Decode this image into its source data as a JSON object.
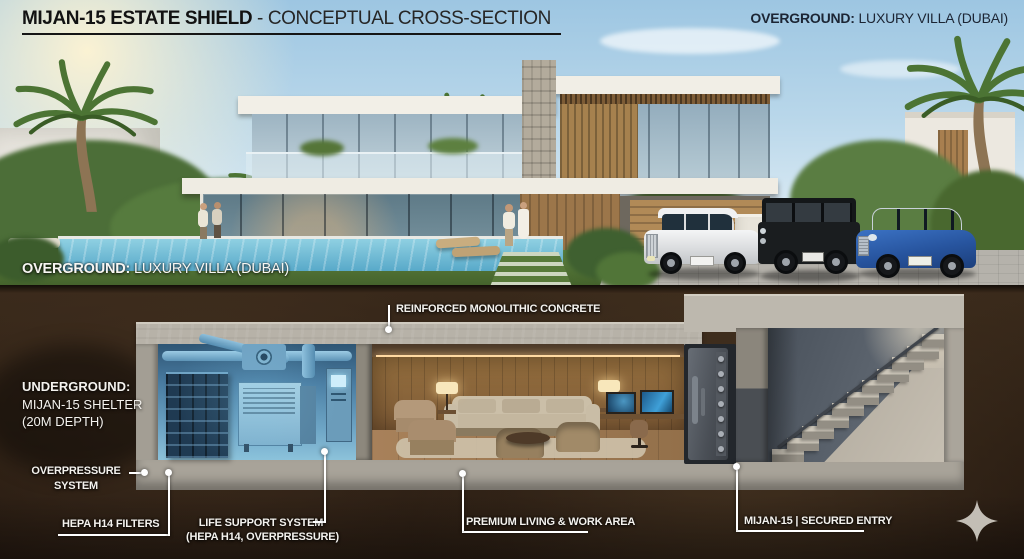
{
  "header": {
    "title_bold": "MIJAN-15 ESTATE SHIELD",
    "title_rest": " - CONCEPTUAL CROSS-SECTION",
    "corner_bold": "OVERGROUND:",
    "corner_rest": " LUXURY VILLA (DUBAI)"
  },
  "overground": {
    "bold": "OVERGROUND:",
    "rest": " LUXURY VILLA (DUBAI)"
  },
  "underground": {
    "line1": "UNDERGROUND:",
    "line2": "MIJAN-15 SHELTER",
    "line3": "(20M DEPTH)"
  },
  "ann": {
    "concrete": "REINFORCED MONOLITHIC CONCRETE",
    "overpressure1": "OVERPRESSURE",
    "overpressure2": "SYSTEM",
    "hepa": "HEPA H14 FILTERS",
    "life1": "LIFE SUPPORT SYSTEM",
    "life2": "(HEPA H14, OVERPRESSURE)",
    "living": "PREMIUM LIVING & WORK AREA",
    "entry": "MIJAN-15 | SECURED ENTRY"
  },
  "logo_icon": "four-point-star",
  "colors": {
    "title_text": "#141414",
    "corner_text": "#1c2534",
    "label_text": "#f4f2ee",
    "soil": "#31231a",
    "concrete": "#b7b2a8",
    "shelter_glow": "#7fb3d4",
    "wood": "#8a6540",
    "sky": "#9dc6e2"
  }
}
